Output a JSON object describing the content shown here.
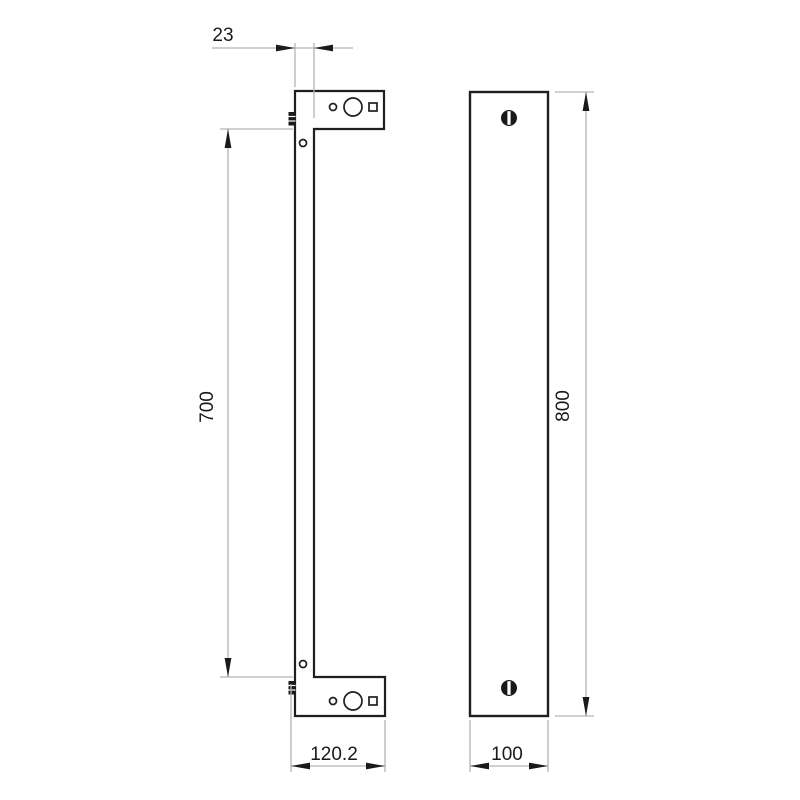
{
  "drawing": {
    "description": "Two-view dimensioned technical drawing of a wall-mount pull handle: side profile with mounting brackets (left) and front face (right)",
    "dimensions": {
      "handle_thickness": "23",
      "hole_spacing": "700",
      "bracket_depth": "120.2",
      "overall_length": "800",
      "face_width": "100"
    },
    "icons": {
      "set_screw": "set-screw-icon",
      "screw_head": "slotted-screw-head-icon"
    },
    "colors": {
      "outline": "#1f1f1f",
      "dimension_line": "#b3b3b3",
      "text": "#1a1a1a",
      "background": "#ffffff"
    }
  }
}
